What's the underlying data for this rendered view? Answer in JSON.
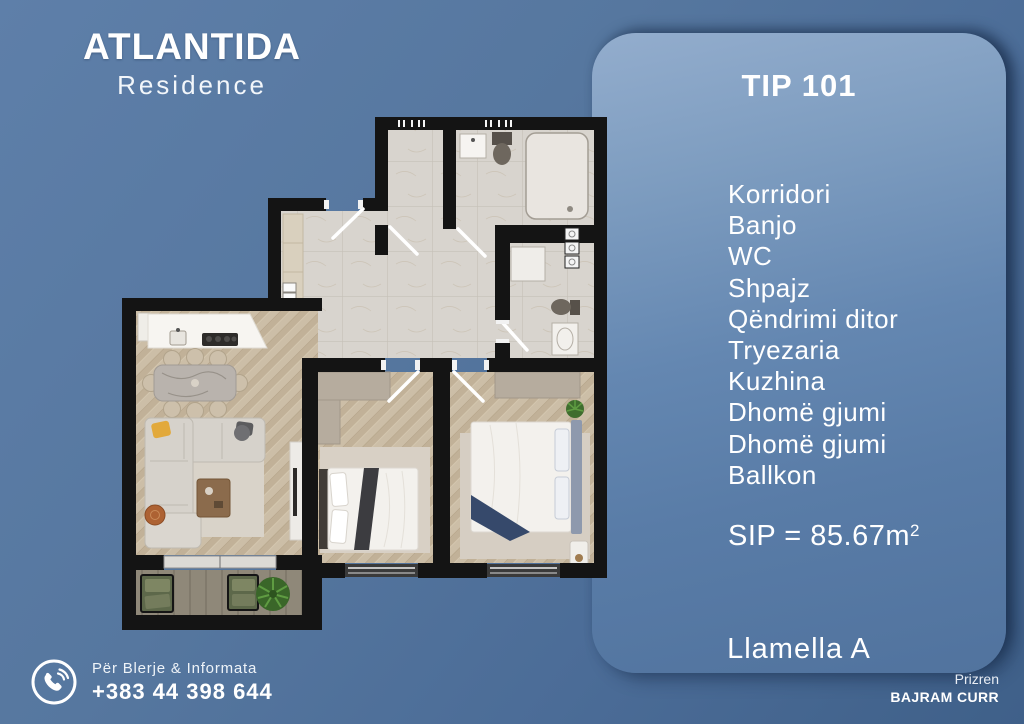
{
  "brand": {
    "title": "ATLANTIDA",
    "subtitle": "Residence"
  },
  "panel": {
    "tip_title": "TIP 101",
    "rooms": [
      "Korridori",
      "Banjo",
      "WC",
      "Shpajz",
      "Qëndrimi ditor",
      "Tryezaria",
      "Kuzhina",
      "Dhomë gjumi",
      "Dhomë gjumi",
      "Ballkon"
    ],
    "area_label": "SIP = 85.67m",
    "area_sup": "2",
    "block_label": "Llamella A"
  },
  "contact": {
    "label": "Për Blerje & Informata",
    "phone": "+383 44 398 644"
  },
  "footer": {
    "city": "Prizren",
    "agent": "BAJRAM CURR"
  },
  "colors": {
    "background_top": "#5e7fa9",
    "background_bottom": "#3f6089",
    "panel_top": "#93adcd",
    "panel_bottom": "#51739e",
    "wall": "#141414",
    "tile_floor": "#d8d4ce",
    "wood_floor": "#c9bba4",
    "balcony_floor": "#8e8778",
    "text": "#ffffff"
  }
}
